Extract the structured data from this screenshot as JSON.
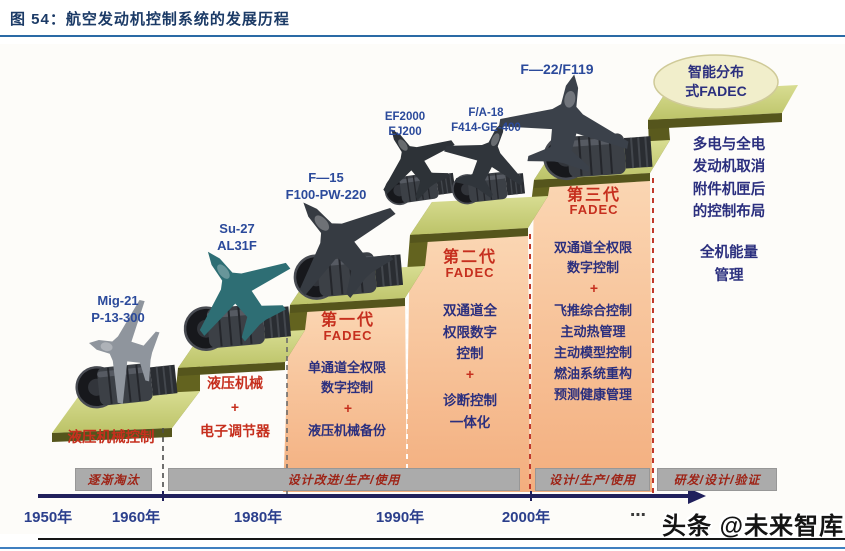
{
  "title": "图 54：航空发动机控制系统的发展历程",
  "aircraft": {
    "mig21": "Mig-21\nP-13-300",
    "su27": "Su-27\nAL31F",
    "f15": "F—15\nF100-PW-220",
    "ef2000": "EF2000\nEJ200",
    "fa18": "F/A-18\nF414-GE-400",
    "f22": "F—22/F119"
  },
  "stages": {
    "s1": {
      "caption": "液压机械控制"
    },
    "s2": {
      "caption": "液压机械\n+\n电子调节器"
    },
    "s3": {
      "gen": "第一代",
      "fadec": "FADEC",
      "top": "单通道全权限\n数字控制",
      "plus": "+",
      "bottom": "液压机械备份"
    },
    "s4": {
      "gen": "第二代",
      "fadec": "FADEC",
      "top": "双通道全\n权限数字\n控制",
      "plus": "+",
      "bottom": "诊断控制\n一体化"
    },
    "s5": {
      "gen": "第三代",
      "fadec": "FADEC",
      "top": "双通道全权限\n数字控制",
      "plus": "+",
      "bottom": "飞推综合控制\n主动热管理\n主动模型控制\n燃油系统重构\n预测健康管理"
    },
    "s6": {
      "oval": "智能分布\n式FADEC",
      "body1": "多电与全电\n发动机取消\n附件机匣后\n的控制布局",
      "body2": "全机能量\n管理"
    }
  },
  "phases": [
    "逐渐淘汰",
    "设计改进/生产/使用",
    "设计/生产/使用",
    "研发/设计/验证"
  ],
  "years": [
    "1950年",
    "1960年",
    "1980年",
    "1990年",
    "2000年"
  ],
  "timeline_ellipsis": "⋯",
  "watermark": "头条 @未来智库",
  "colors": {
    "title_blue": "#1b3a66",
    "label_blue": "#2b4a9b",
    "body_blue": "#2b2f7e",
    "accent_red": "#c62f1e",
    "panel_orange": "#f7c49c",
    "tread_green": "#c9cf7a",
    "olive_dark": "#5d5d20",
    "band_gray": "#ababab",
    "timeline_navy": "#20205c"
  }
}
